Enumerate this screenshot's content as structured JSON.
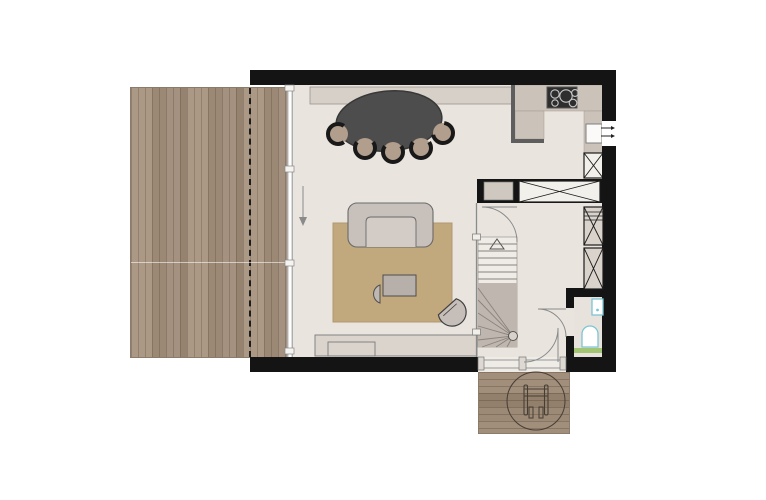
{
  "app": {
    "kind": "architectural-floor-plan",
    "view": "top-down ground floor",
    "visible_text": "none"
  },
  "palette": {
    "background": "#ffffff",
    "wall": "#141414",
    "floor": "#e9e5de",
    "deck_wood": "#a39078",
    "entry_deck_wood": "#9a8874",
    "kitchen_counter": "#cbc3ba",
    "counter_edge": "#5e5e5e",
    "dining_table": "#4d4d4d",
    "chair_seat": "#b29e8d",
    "chair_back": "#191919",
    "rug": "#c2a87d",
    "sofa": "#c8c0ba",
    "cabinet_fill": "#d9d3cb",
    "stair_winder": "#bfb7af",
    "glass_line": "#8a8a8a",
    "fixture_outline": "#7cc4d4",
    "shower_mat": "#a2c573",
    "deck_symbol_line": "#463e34"
  },
  "plan": {
    "terrace_left": {
      "label": "wood terrace, vertical planks with dashed roof-overhang line"
    },
    "entrance_deck": {
      "label": "entry deck, horizontal planks with wheelchair turning circle"
    },
    "living_dining": {
      "label": "living / dining room behind full-height glazing",
      "furniture": [
        "oval dining table",
        "dining chairs",
        "sideboard along top wall",
        "sofa",
        "rug",
        "coffee table",
        "half-round side table",
        "armchair",
        "low tv cabinet"
      ],
      "dining_chairs_count": 5
    },
    "kitchen": {
      "label": "kitchen corner, L-shaped counter",
      "fixtures": [
        "4-zone cooktop",
        "sink with supply arrows",
        "tall cabinet (X symbol)"
      ],
      "cooktop_burners": 4
    },
    "hall": {
      "label": "hall with winder staircase going up",
      "features": [
        "stair up-arrow",
        "door to living room",
        "door to wc",
        "entrance door",
        "built-in wardrobe (X symbol)",
        "two tall cabinets (X symbols)"
      ]
    },
    "wc": {
      "label": "wc with wash basin, toilet and green mat strip"
    },
    "glazing": {
      "label": "west glass wall, sliding panel direction arrow pointing down"
    }
  }
}
